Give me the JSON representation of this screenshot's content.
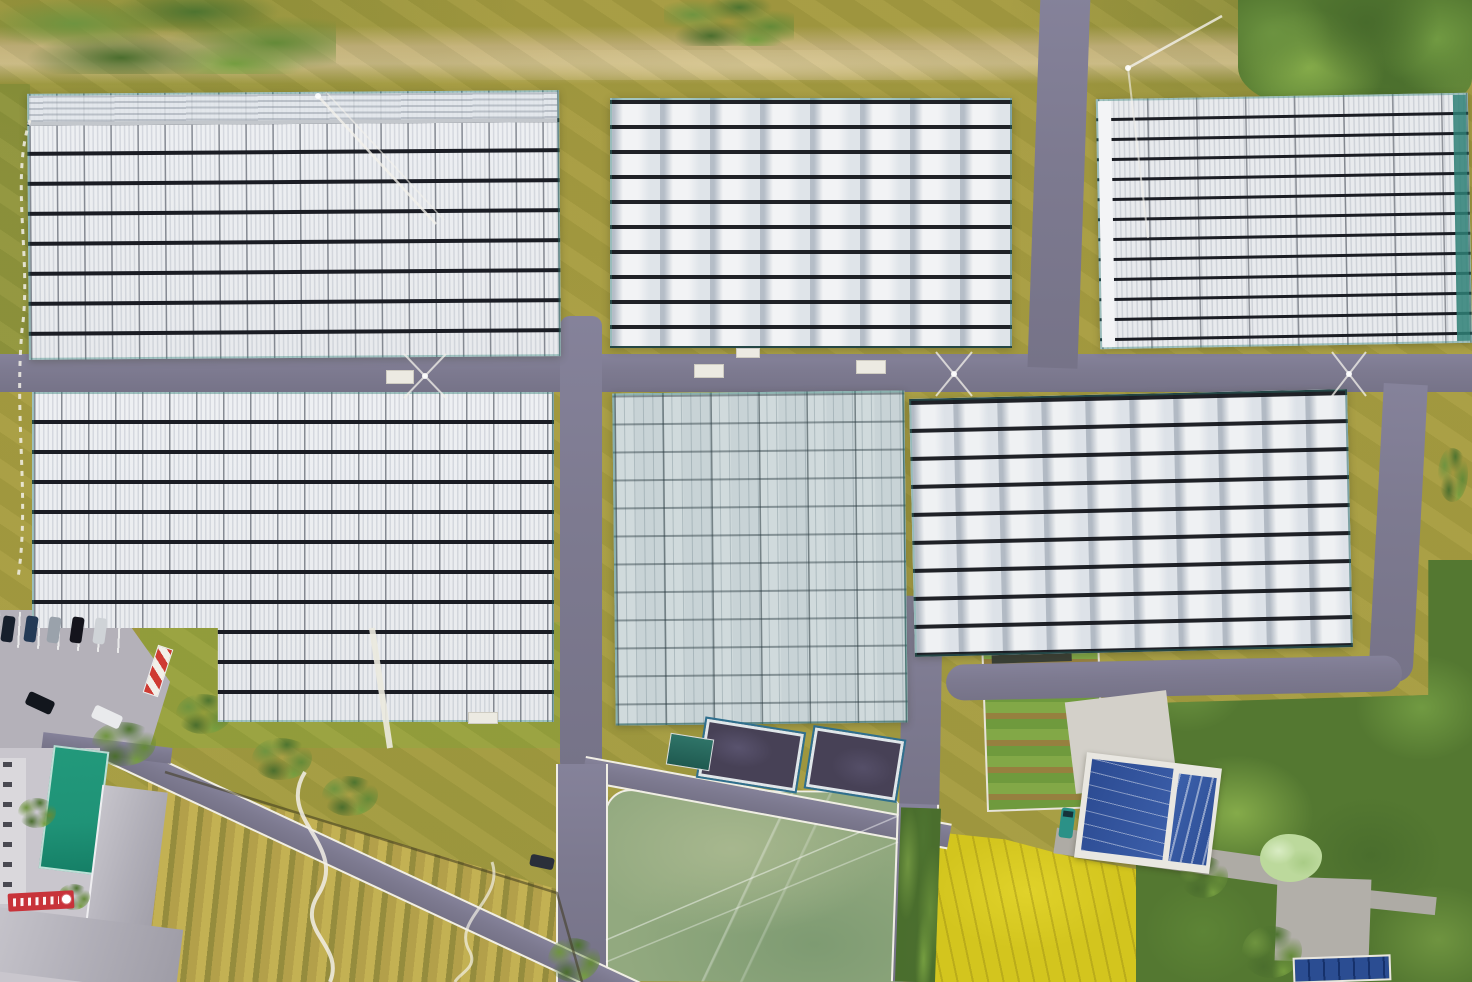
{
  "title": "Aerial drone photograph of a greenhouse farm complex",
  "scene_summary": "Top-down daytime aerial view of six large greenhouse blocks arranged around a cross of asphalt roads, with an irrigation pond, two dark water tanks, an orchard with winding footpaths, a yellow rice paddy, vegetable garden plots, a blue-roofed farm building, a gray-roofed office building with green court, parked cars, and tree belts on olive-yellow grass",
  "palette": {
    "grass": "#a79c41",
    "grass-green": "#96a03d",
    "dirt": "#c9b584",
    "gravel": "#d6c593",
    "road": "#7d7a90",
    "road-light": "#b4b1b9",
    "pavement": "#d3d0c9",
    "curb": "#f0eee5",
    "gh-white": "#e8eaed",
    "gh-line": "#1b1d24",
    "gh-blue": "#c8d3d6",
    "teal": "#2e8076",
    "pond": "#92a97f",
    "tank": "#474156",
    "tank-frame": "#2f6f8e",
    "rice": "#d3c51e",
    "orchard-a": "#c3b153",
    "orchard-b": "#958c3d",
    "tree": "#547831",
    "tree-pale": "#bcd99c",
    "roof-gray": "#b1afb8",
    "roof-blue": "#2c4b92",
    "roof-blue2": "#3c60aa",
    "pool": "#1f9377",
    "sign-red": "#c8333a"
  },
  "areas": {
    "greenhouse_blocks": [
      {
        "id": "top-left",
        "roof": "white glass with ridged panels",
        "dark_row_lines": 9
      },
      {
        "id": "top-center",
        "roof": "white plastic barrel vaults",
        "columns": 8,
        "rows": 10
      },
      {
        "id": "top-right",
        "roof": "white vaults, dense rows",
        "columns": 7,
        "rows": 13
      },
      {
        "id": "middle-left",
        "roof": "white glass with ridged panels",
        "dark_row_lines": 10,
        "shape": "L-shaped"
      },
      {
        "id": "middle-center",
        "roof": "fine-grid glass",
        "tint": "blue-gray"
      },
      {
        "id": "middle-right",
        "roof": "white plastic barrel vaults",
        "columns": 10,
        "rows": 9
      }
    ],
    "water": {
      "pond": "large murky-green irrigation pond with white-curbed perimeter roads",
      "tank_count": 2,
      "tanks": "dark open reservoirs with white and blue frames",
      "shed": "small teal-roofed pump shed"
    },
    "fields": {
      "orchard": "row-planted orchard with white winding footpaths",
      "rice_paddy": "bright yellow rice field with faint row lines",
      "vegetable_garden": "striped garden plots with white border path"
    },
    "buildings": {
      "farm_building": "white building with two dark-blue roof slabs",
      "office_building": "L-shaped gray-roofed building with courtyard",
      "green_court": "teal-green rectangular court beside office",
      "solar_panels": "blue panel array at bottom edge"
    },
    "vehicles": {
      "parked_cars": 5,
      "cars_on_road": 3,
      "teal_truck": 1
    },
    "roads": {
      "main_cross": "purple-gray asphalt roads crossing between blocks",
      "perimeter": "white edge lines around pond and field roads",
      "dirt_path": "tan dirt track along the top edge"
    },
    "misc": {
      "red_sign": "red banner with illegible white characters near office",
      "striped_barrier": "red-white striped barrier near parking",
      "power_lines": "white guy wires at poles along roads",
      "fence": "white dashed fence arc on the left margin"
    }
  }
}
